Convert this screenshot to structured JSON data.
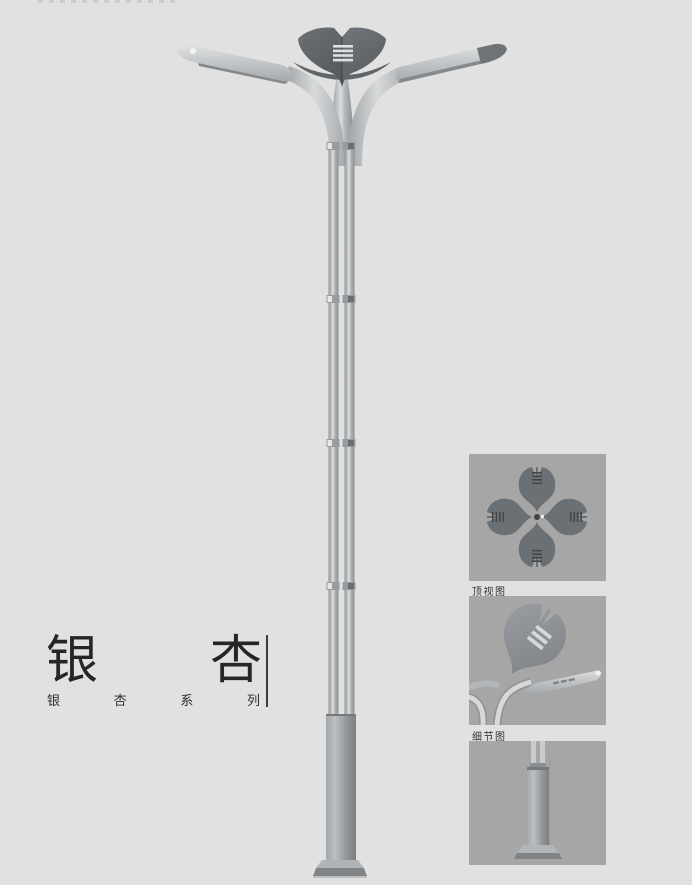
{
  "page": {
    "background": "#e1e1e1"
  },
  "title": {
    "chars": [
      "银",
      "杏"
    ],
    "series_chars": [
      "银",
      "杏",
      "系",
      "列"
    ]
  },
  "panels": [
    {
      "caption": "顶视图"
    },
    {
      "caption": "细节图"
    },
    {
      "caption": ""
    }
  ],
  "colors": {
    "page_background": "#e1e1e1",
    "panel_background": "#a6a6a6",
    "title_text": "#262626",
    "caption_text": "#2f3133",
    "lamp_silver": "#c7cacc",
    "lamp_dark": "#5d6165",
    "base_gray": "#8f9396"
  }
}
